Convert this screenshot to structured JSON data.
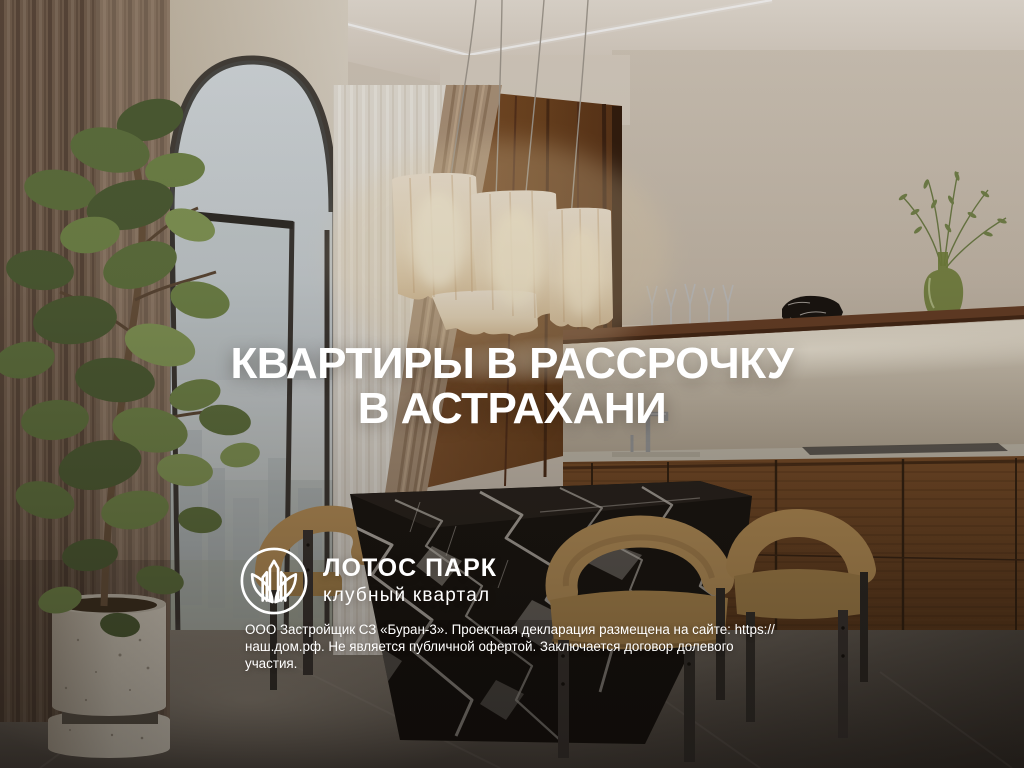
{
  "banner": {
    "headline": {
      "line1": "КВАРТИРЫ В РАССРОЧКУ",
      "line2": "В АСТРАХАНИ"
    },
    "brand": {
      "name": "ЛОТОС ПАРК",
      "tagline": "клубный квартал"
    },
    "disclaimer": {
      "line1": "ООО Застройщик СЗ «Буран-3». Проектная декларация размещена на сайте: https://",
      "line2": "наш.дом.рф. Не является публичной офертой. Заключается договор долевого участия."
    }
  },
  "icons": {
    "logo": "lotus-circle-buildings-icon"
  },
  "colors": {
    "text": "#ffffff",
    "wall": "#d3c8ba",
    "wood_panel": "#7a4c2a",
    "kitchen_cabinet": "#6f4526",
    "marble_table": "#16130f",
    "chair_upholstery": "#c49a5e",
    "curtain_taupe": "#8a7461",
    "sheer_curtain": "#ebe6de",
    "foliage_green": "#6d814a",
    "lamp_glow": "#f6e8cd",
    "floor": "#6e675f"
  }
}
